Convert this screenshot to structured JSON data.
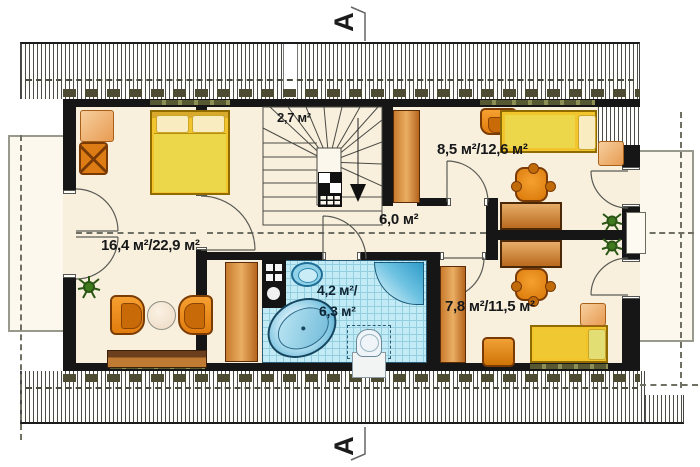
{
  "plan": {
    "section_marker_top": "A",
    "section_marker_bottom": "A",
    "rooms": [
      {
        "id": "staircase",
        "area_label": "2,7 м²"
      },
      {
        "id": "room_top_right",
        "area_label": "8,5 м²/12,6 м²"
      },
      {
        "id": "hallway",
        "area_label": "6,0 м²"
      },
      {
        "id": "living_room",
        "area_label": "16,4 м²/22,9 м²"
      },
      {
        "id": "bathroom_line_1",
        "area_label": "4,2 м²/"
      },
      {
        "id": "bathroom_line_2",
        "area_label": "6,3 м²"
      },
      {
        "id": "room_bottom_right",
        "area_label": "7,8 м²/11,5 м²"
      }
    ],
    "colors": {
      "floor": "#f8f0dd",
      "wall": "#161616",
      "bathroom_tile": "#c3ebf5",
      "furniture_orange": "#e8901f",
      "bed_yellow": "#f3c52c",
      "wood_brown": "#b96a1e",
      "water_blue": "#7cc4e0",
      "plant_green": "#2b5514"
    }
  }
}
